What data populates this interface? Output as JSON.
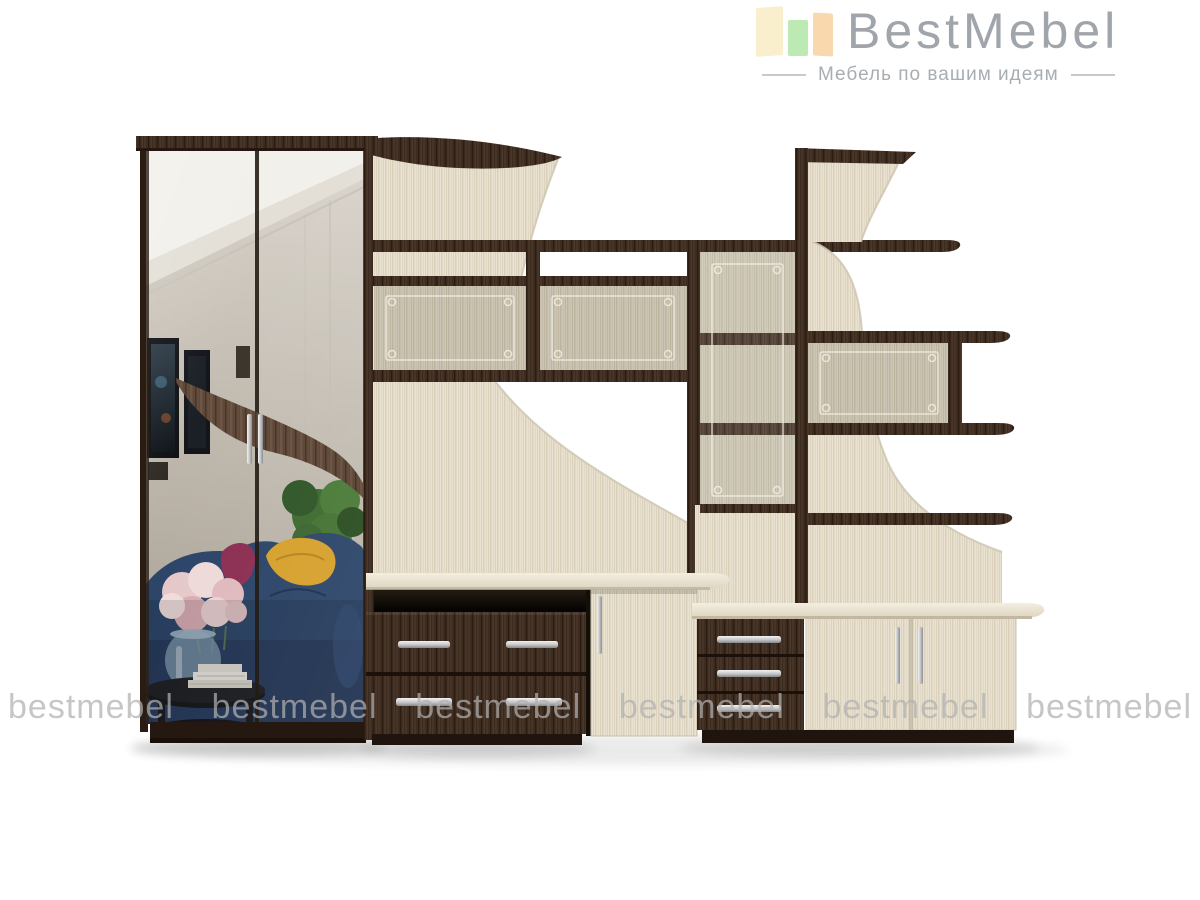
{
  "brand": {
    "name": "BestMebel",
    "tagline": "Мебель по вашим идеям"
  },
  "watermark": {
    "text": "bestmebel",
    "count": 6
  },
  "colors": {
    "logo-text": "#a0a5ab",
    "logo-tagline": "#a8adb2",
    "logo-bar-1": "#f9efcd",
    "logo-bar-2": "#bdeab2",
    "logo-bar-3": "#f9d8ad",
    "watermark": "#b1b1b1",
    "wenge-wood": "#3b2a1e",
    "oak-wood": "#e9e2d0",
    "glass-panel": "#ccc5b3",
    "cream-top": "#f0e9da",
    "sofa-blue": "#2b4468",
    "pillow-yellow": "#d6a02c",
    "pillow-magenta": "#8c2e52"
  }
}
